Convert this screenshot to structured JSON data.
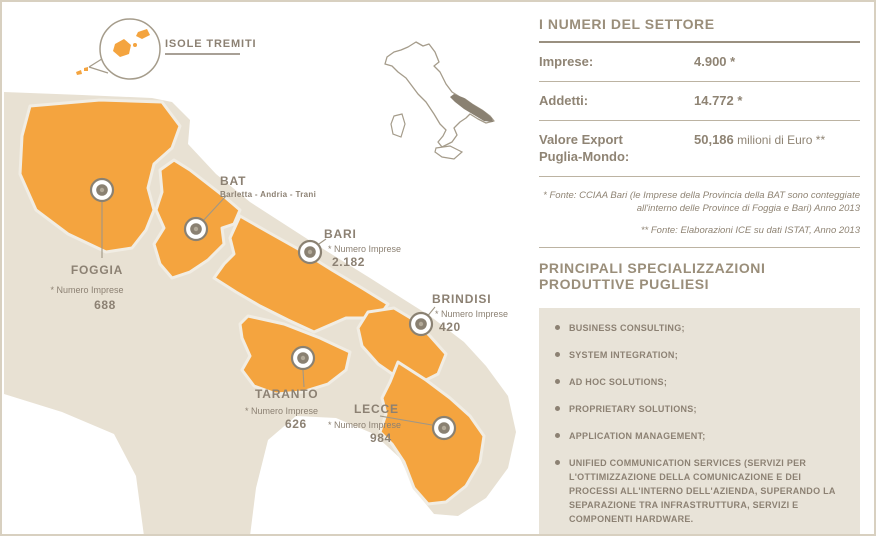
{
  "map": {
    "isole_tremiti": {
      "label": "ISOLE TREMITI"
    },
    "provinces": {
      "foggia": {
        "name": "FOGGIA",
        "stat_label": "* Numero Imprese",
        "value": "688"
      },
      "bat": {
        "name": "BAT",
        "subtitle": "Barletta - Andria - Trani"
      },
      "bari": {
        "name": "BARI",
        "stat_label": "* Numero Imprese",
        "value": "2.182"
      },
      "brindisi": {
        "name": "BRINDISI",
        "stat_label": "* Numero Imprese",
        "value": "420"
      },
      "taranto": {
        "name": "TARANTO",
        "stat_label": "* Numero Imprese",
        "value": "626"
      },
      "lecce": {
        "name": "LECCE",
        "stat_label": "* Numero Imprese",
        "value": "984"
      }
    }
  },
  "panel": {
    "title": "I NUMERI DEL SETTORE",
    "stats": [
      {
        "label": "Imprese:",
        "value": "4.900 *"
      },
      {
        "label": "Addetti:",
        "value": "14.772 *"
      },
      {
        "label_line1": "Valore Export",
        "label_line2": "Puglia-Mondo:",
        "value_strong": "50,186",
        "value_rest": " milioni di Euro **"
      }
    ],
    "footnotes": [
      "* Fonte: CCIAA Bari (le Imprese della Provincia della BAT sono conteggiate all'interno delle Province di Foggia e Bari) Anno 2013",
      "** Fonte: Elaborazioni ICE su dati ISTAT, Anno 2013"
    ],
    "specializations_title": "PRINCIPALI SPECIALIZZAZIONI PRODUTTIVE PUGLIESI",
    "specializations": [
      "BUSINESS CONSULTING;",
      "SYSTEM INTEGRATION;",
      "AD HOC SOLUTIONS;",
      "PROPRIETARY SOLUTIONS;",
      "APPLICATION MANAGEMENT;",
      "UNIFIED COMMUNICATION SERVICES (SERVIZI PER L'OTTIMIZZAZIONE DELLA COMUNICAZIONE E DEI PROCESSI ALL'INTERNO DELL'AZIENDA, SUPERANDO LA SEPARAZIONE TRA INFRASTRUTTURA, SERVIZI E COMPONENTI HARDWARE."
    ]
  },
  "colors": {
    "accent_orange": "#f4a43f",
    "land_beige": "#e8e1d3",
    "panel_box_beige": "#e8e3d8",
    "text_brown": "#8c8173",
    "highlight_region": "#8a8172"
  }
}
